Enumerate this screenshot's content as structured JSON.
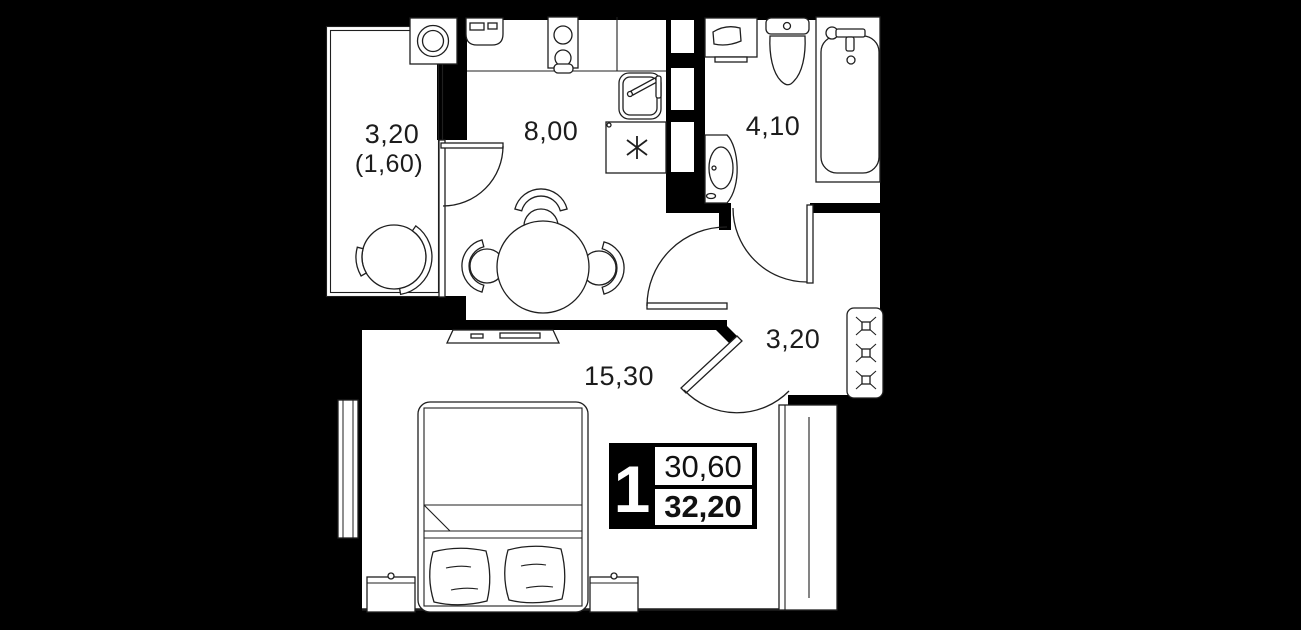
{
  "floor_plan": {
    "type_label": "1-room apartment plan",
    "balcony": {
      "area": "3,20",
      "area_reduced": "(1,60)"
    },
    "kitchen": {
      "area": "8,00"
    },
    "bathroom": {
      "area": "4,10"
    },
    "living_room": {
      "area": "15,30"
    },
    "hallway": {
      "area": "3,20"
    },
    "summary": {
      "rooms_count": "1",
      "living_area": "30,60",
      "total_area": "32,20"
    },
    "colors": {
      "background": "#000000",
      "floor": "#ffffff",
      "walls": "#000000",
      "lines": "#1f1f1f"
    }
  }
}
